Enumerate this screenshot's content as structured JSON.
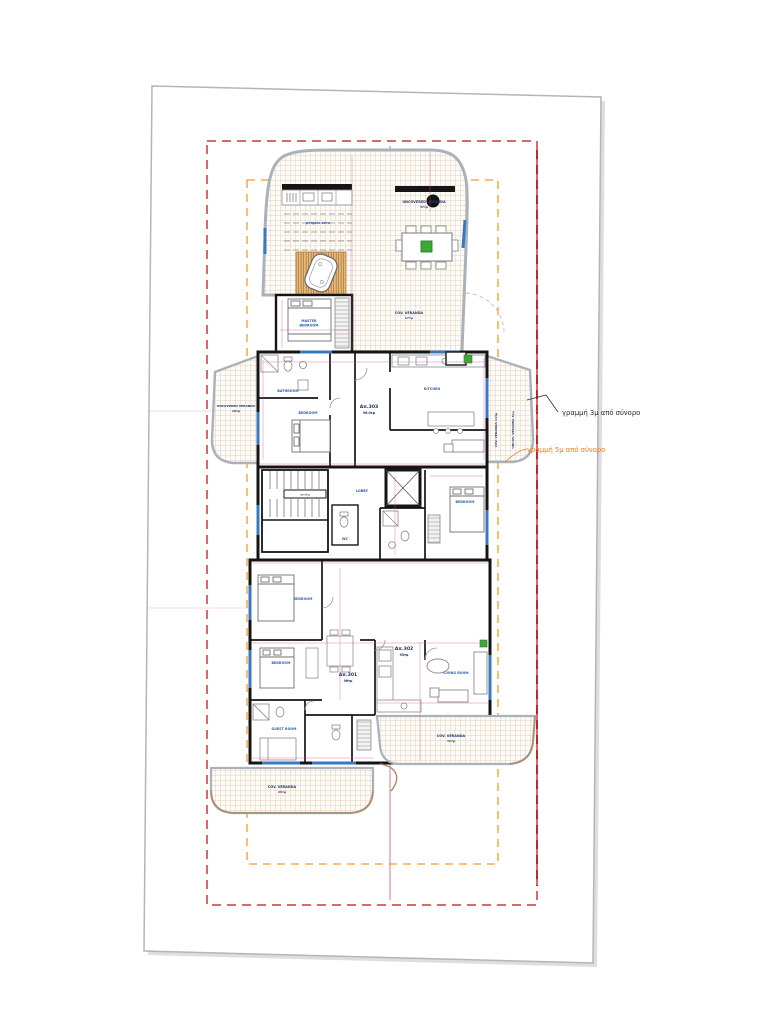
{
  "drawing": {
    "type": "architectural floor plan",
    "sheet": "tilted white drawing sheet"
  },
  "annotations": {
    "boundary_3m": "γραμμή 3μ από σύνορο",
    "boundary_5m": "γραμμή 5μ από σύνορο"
  },
  "apartments": {
    "a303": {
      "id": "Απ.303",
      "area": "96.0τμ"
    },
    "a301": {
      "id": "Απ.301",
      "area": "96τμ"
    },
    "a302": {
      "id": "Απ.302",
      "area": "93τμ"
    }
  },
  "verandas": {
    "top_uncovered": {
      "name": "UNCOVERED VERANDA",
      "area": "37τμ"
    },
    "top_covered": {
      "name": "COV. VERANDA",
      "area": "17τμ"
    },
    "left": {
      "name": "UNCOVERED VERANDA",
      "area": "16τμ"
    },
    "right_covered": {
      "name": "COV. VERANDA 11τμ"
    },
    "right_uncov": {
      "name": "UNCOV. VERANDA 5τμ"
    },
    "bottom_right": {
      "name": "COV. VERANDA",
      "area": "32τμ"
    },
    "bottom_left": {
      "name": "COV. VERANDA",
      "area": "23τμ"
    }
  },
  "rooms": {
    "master_bedroom_1": "MASTER",
    "master_bedroom_2": "BEDROOM",
    "bedroom": "BEDROOM",
    "bathroom": "BATHROOM",
    "kitchen": "KITCHEN",
    "living_room": "LIVING ROOM",
    "guest_room": "GUEST ROOM",
    "wc": "WC",
    "lobby": "LOBBY",
    "pergola": "pergola area",
    "landing": "landing"
  },
  "colors": {
    "boundary_red": "#cf3636",
    "boundary_red_dark": "#b01818",
    "setback_orange": "#f49b2a",
    "window_blue": "#3a78c2",
    "label_blue": "#2458a8",
    "dimension_magenta": "#d94f9a",
    "plant_green": "#3aaa35",
    "annotation_dark": "#1d2433",
    "annotation_orange": "#f07d1a"
  }
}
